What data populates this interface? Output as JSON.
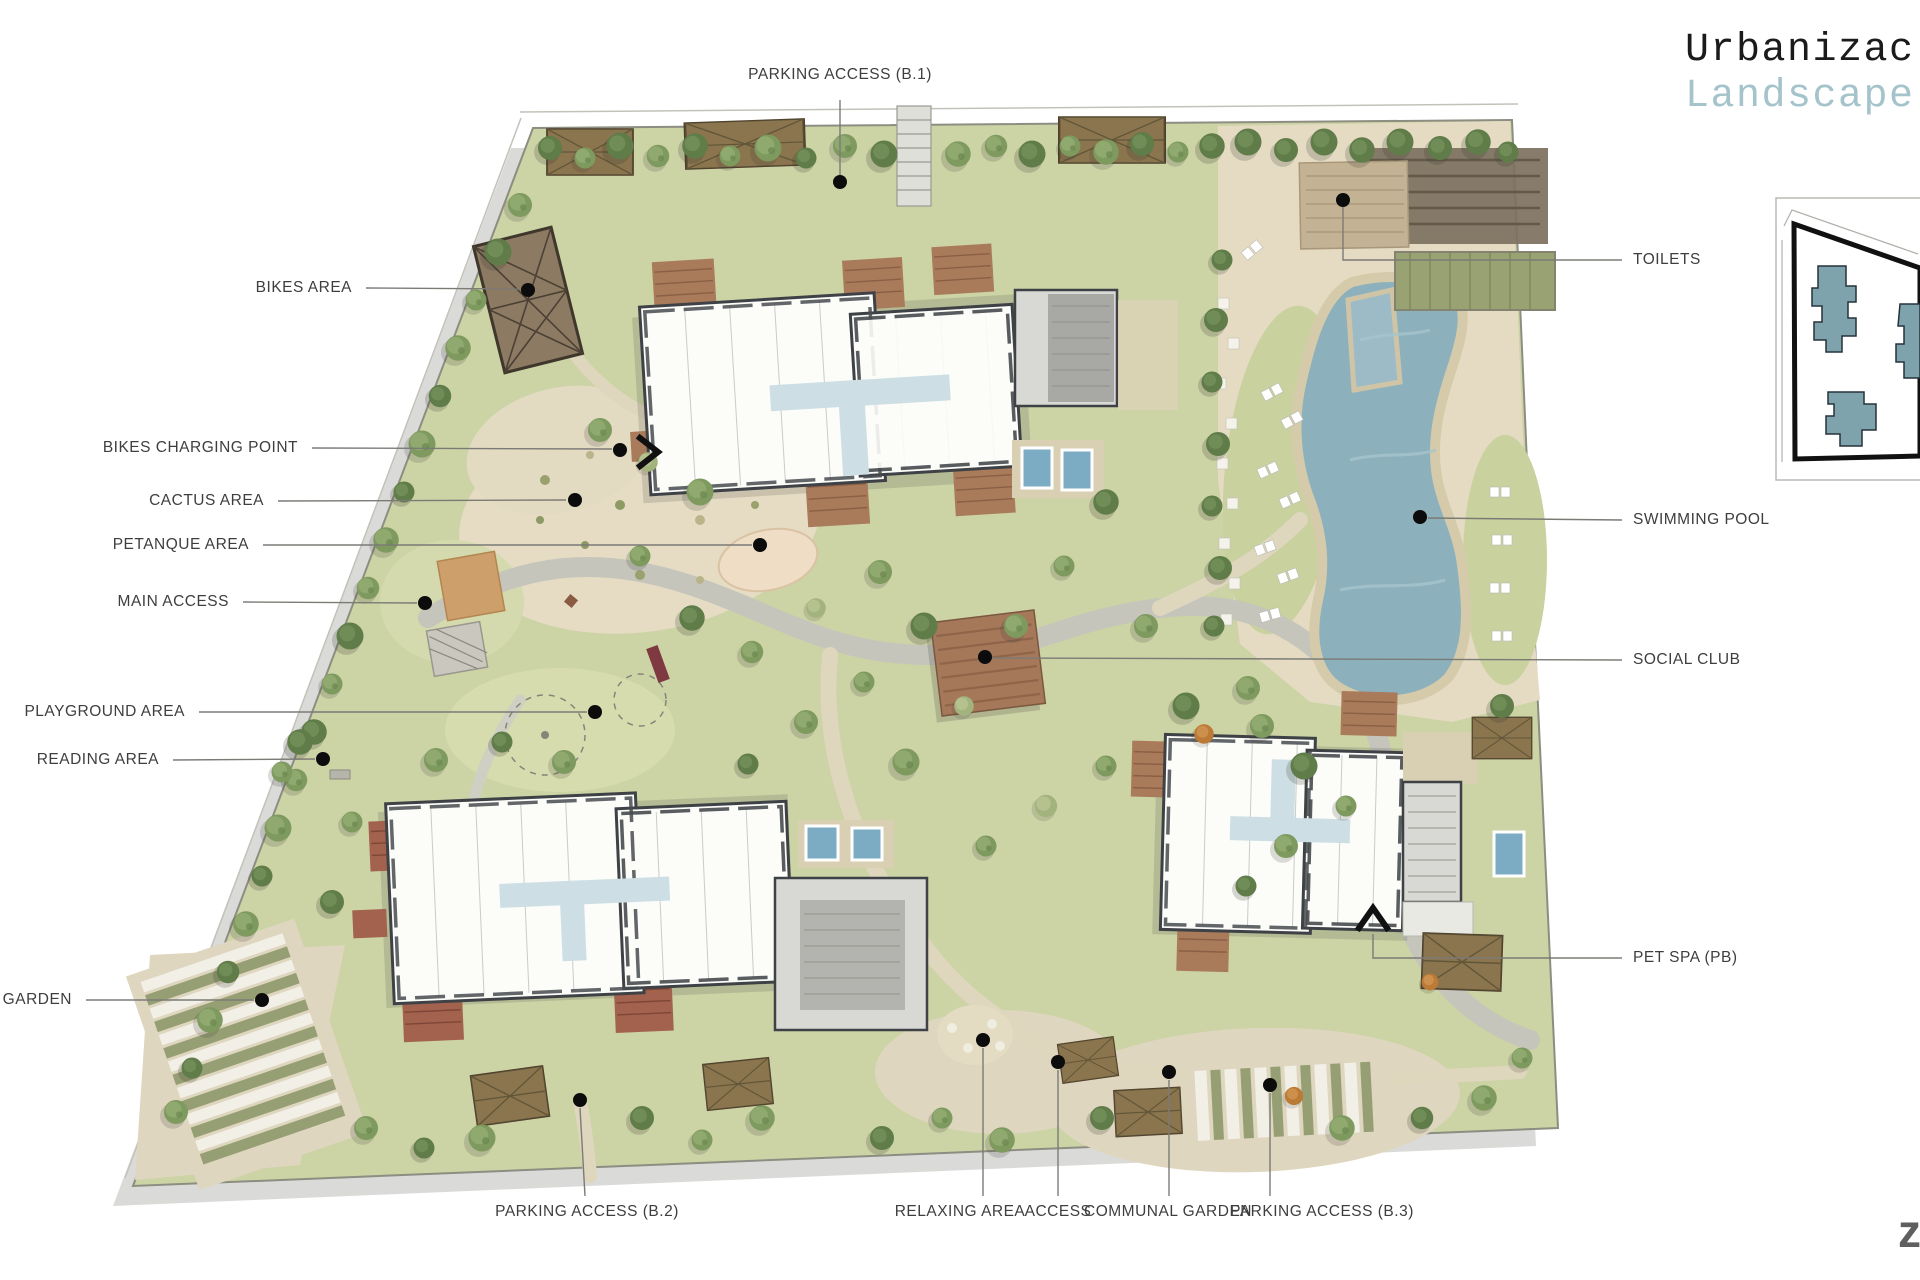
{
  "title": {
    "line1": "Urbanizac",
    "line2": "Landscape"
  },
  "watermark": {
    "text": "z"
  },
  "labels": {
    "top": [
      {
        "text": "PARKING ACCESS (B.1)"
      }
    ],
    "left": [
      {
        "text": "BIKES AREA"
      },
      {
        "text": "BIKES CHARGING POINT"
      },
      {
        "text": "CACTUS AREA"
      },
      {
        "text": "PETANQUE AREA"
      },
      {
        "text": "MAIN ACCESS"
      },
      {
        "text": "PLAYGROUND AREA"
      },
      {
        "text": "READING AREA"
      },
      {
        "text": "L GARDEN"
      }
    ],
    "right": [
      {
        "text": "TOILETS"
      },
      {
        "text": "SWIMMING POOL"
      },
      {
        "text": "SOCIAL CLUB"
      },
      {
        "text": "PET SPA (PB)"
      }
    ],
    "bottom": [
      {
        "text": "PARKING ACCESS (B.2)"
      },
      {
        "text": "RELAXING AREA"
      },
      {
        "text": "ACCESS"
      },
      {
        "text": "COMMUNAL GARDEN"
      },
      {
        "text": "PARKING ACCESS (B.3)"
      }
    ]
  },
  "icons": {
    "access_marker_up": "chevron-up",
    "access_marker_right": "chevron-right",
    "logo_mark": "z-logo"
  },
  "colors": {
    "title_text": "#1b1b1b",
    "title_accent_blue": "#a4c3ca",
    "label_text": "#3e3e3e",
    "leader_line": "#7b7b76",
    "anchor_dot": "#0c0c0c",
    "site_green": "#ccd3a5",
    "path_gray": "#c6c5bb",
    "sand_beige": "#e5dcc3",
    "pool_blue": "#8db1bc",
    "terrace_brown": "#a87a5a",
    "building_white": "#fcfcf9",
    "building_wall": "#3e4246",
    "annex_gray": "#d8d8d4",
    "inset_building_blue": "#7fa3ad"
  }
}
